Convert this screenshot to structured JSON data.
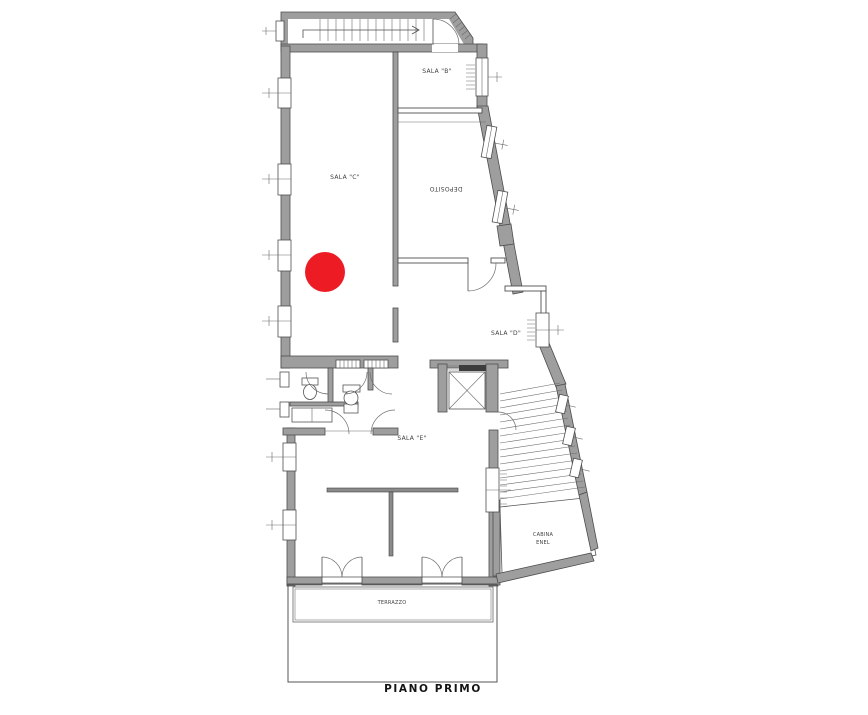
{
  "plan": {
    "title": "PIANO PRIMO",
    "rooms": {
      "sala_b": "SALA \"B\"",
      "sala_c": "SALA \"C\"",
      "deposito": "DEPOSITO",
      "sala_d": "SALA \"D\"",
      "sala_e": "SALA \"E\"",
      "cabina_line1": "CABINA",
      "cabina_line2": "ENEL",
      "terrazzo": "TERRAZZO"
    },
    "marker": {
      "color": "#ed1c24"
    },
    "wall_color": "#9e9e9e"
  }
}
